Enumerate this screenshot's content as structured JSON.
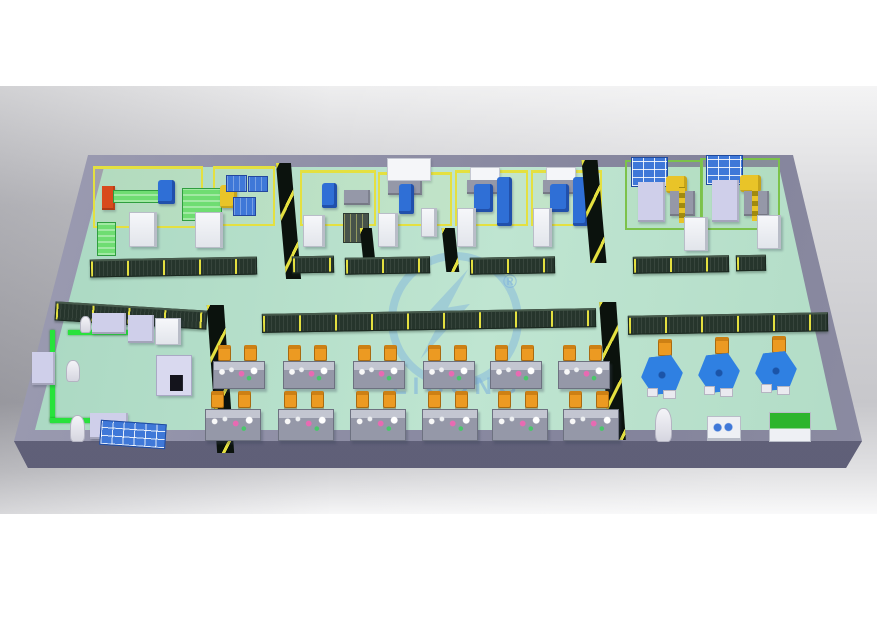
{
  "watermark": {
    "text": "LIGONG",
    "registered_mark": "®"
  },
  "colors": {
    "background_gray": "#bfbfc6",
    "platform_wall": "#8d8da3",
    "platform_front": "#5e5e77",
    "floor_green": "#b5ddc8",
    "fence_yellow": "#e4e040",
    "fence_green": "#7cc24a",
    "mesh_dark": "#26352c",
    "partition_dark": "#0b120d",
    "conveyor_green": "#28e23c",
    "robot_blue": "#2f6fd6",
    "robot_yellow": "#e9c428",
    "machine_white": "#eef0f4",
    "machine_lavender": "#cfcfea",
    "machine_red": "#d84a1c",
    "pallet_blue": "#3f78d8",
    "pallet_green": "#6fdd72",
    "bench_gray": "#9598a8",
    "chair_orange": "#ec9a22",
    "table_blue": "#2f80e2",
    "watermark_blue": "#7fb3dd"
  },
  "scene": {
    "objects": [
      {
        "n": "robot-cell-a-left-fence",
        "k": "yfence",
        "x": 93,
        "y": 166,
        "w": 110,
        "h": 62
      },
      {
        "n": "robot-cell-a-right-fence",
        "k": "yfence",
        "x": 213,
        "y": 166,
        "w": 62,
        "h": 60
      },
      {
        "n": "robot-cell-b-fence",
        "k": "yfence",
        "x": 300,
        "y": 170,
        "w": 76,
        "h": 56
      },
      {
        "n": "robot-cell-c-fence",
        "k": "yfence",
        "x": 378,
        "y": 172,
        "w": 74,
        "h": 54
      },
      {
        "n": "robot-cell-d-fence",
        "k": "yfence",
        "x": 455,
        "y": 170,
        "w": 73,
        "h": 56
      },
      {
        "n": "robot-cell-e-fence",
        "k": "yfence",
        "x": 531,
        "y": 170,
        "w": 71,
        "h": 56
      },
      {
        "n": "robot-cell-f-fence",
        "k": "gfence",
        "x": 625,
        "y": 160,
        "w": 78,
        "h": 70
      },
      {
        "n": "robot-cell-g-fence",
        "k": "gfence",
        "x": 700,
        "y": 158,
        "w": 80,
        "h": 72
      },
      {
        "n": "red-loader-machine",
        "k": "block",
        "c": "machine_red",
        "x": 102,
        "y": 186,
        "w": 13,
        "h": 24
      },
      {
        "n": "conveyor-bench-1",
        "k": "gbench",
        "x": 113,
        "y": 190,
        "w": 48,
        "h": 13
      },
      {
        "n": "robot-arm-blue-1",
        "k": "robot-b",
        "x": 158,
        "y": 180,
        "w": 17,
        "h": 24
      },
      {
        "n": "pallet-stack-green",
        "k": "gbench",
        "x": 182,
        "y": 188,
        "w": 40,
        "h": 33
      },
      {
        "n": "robot-arm-yellow-1",
        "k": "robot-y",
        "x": 220,
        "y": 185,
        "w": 17,
        "h": 23
      },
      {
        "n": "pallet-blue-1",
        "k": "bluepal",
        "x": 226,
        "y": 175,
        "w": 21,
        "h": 17
      },
      {
        "n": "pallet-blue-2",
        "k": "bluepal",
        "x": 248,
        "y": 176,
        "w": 20,
        "h": 16
      },
      {
        "n": "pallet-blue-3",
        "k": "bluepal",
        "x": 233,
        "y": 197,
        "w": 23,
        "h": 19
      },
      {
        "n": "control-cabinet-1",
        "k": "cab",
        "x": 129,
        "y": 212,
        "w": 28,
        "h": 35
      },
      {
        "n": "control-cabinet-2",
        "k": "cab",
        "x": 195,
        "y": 212,
        "w": 28,
        "h": 36
      },
      {
        "n": "conveyor-bench-2",
        "k": "gbench",
        "x": 97,
        "y": 222,
        "w": 19,
        "h": 34
      },
      {
        "n": "robot-arm-blue-2",
        "k": "robot-b",
        "x": 322,
        "y": 183,
        "w": 15,
        "h": 25
      },
      {
        "n": "work-table-1",
        "k": "block",
        "c": "bench_gray",
        "x": 344,
        "y": 190,
        "w": 26,
        "h": 15
      },
      {
        "n": "control-cabinet-3",
        "k": "cab",
        "x": 303,
        "y": 215,
        "w": 22,
        "h": 32
      },
      {
        "n": "mesh-cabinet-1",
        "k": "meshcab",
        "x": 343,
        "y": 213,
        "w": 26,
        "h": 30
      },
      {
        "n": "overhead-panel-1",
        "k": "panel",
        "x": 387,
        "y": 158,
        "w": 44,
        "h": 23
      },
      {
        "n": "machine-base-1",
        "k": "block",
        "c": "bench_gray",
        "x": 388,
        "y": 181,
        "w": 34,
        "h": 14
      },
      {
        "n": "robot-arm-blue-3",
        "k": "robot-b",
        "x": 399,
        "y": 184,
        "w": 15,
        "h": 30
      },
      {
        "n": "control-cabinet-4",
        "k": "cab",
        "x": 378,
        "y": 213,
        "w": 20,
        "h": 34
      },
      {
        "n": "control-cabinet-5",
        "k": "cab",
        "x": 421,
        "y": 208,
        "w": 16,
        "h": 29
      },
      {
        "n": "overhead-panel-2",
        "k": "panel",
        "x": 470,
        "y": 167,
        "w": 30,
        "h": 16
      },
      {
        "n": "machine-base-2",
        "k": "block",
        "c": "bench_gray",
        "x": 467,
        "y": 180,
        "w": 33,
        "h": 14
      },
      {
        "n": "robot-arm-blue-4",
        "k": "robot-b",
        "x": 474,
        "y": 184,
        "w": 19,
        "h": 28
      },
      {
        "n": "gantry-unit-1",
        "k": "robot-b",
        "x": 497,
        "y": 177,
        "w": 15,
        "h": 49
      },
      {
        "n": "control-cabinet-6",
        "k": "cab",
        "x": 457,
        "y": 208,
        "w": 19,
        "h": 39
      },
      {
        "n": "overhead-panel-3",
        "k": "panel",
        "x": 546,
        "y": 167,
        "w": 30,
        "h": 16
      },
      {
        "n": "machine-base-3",
        "k": "block",
        "c": "bench_gray",
        "x": 543,
        "y": 180,
        "w": 33,
        "h": 14
      },
      {
        "n": "robot-arm-blue-5",
        "k": "robot-b",
        "x": 550,
        "y": 184,
        "w": 19,
        "h": 28
      },
      {
        "n": "gantry-unit-2",
        "k": "robot-b",
        "x": 573,
        "y": 177,
        "w": 15,
        "h": 49
      },
      {
        "n": "control-cabinet-7",
        "k": "cab",
        "x": 533,
        "y": 208,
        "w": 19,
        "h": 39
      },
      {
        "n": "parts-rack-1",
        "k": "rack",
        "x": 631,
        "y": 157,
        "w": 37,
        "h": 30
      },
      {
        "n": "machine-lavender-1",
        "k": "block",
        "c": "machine_lavender",
        "x": 638,
        "y": 182,
        "w": 27,
        "h": 40
      },
      {
        "n": "robot-arm-yellow-2",
        "k": "robot-y",
        "x": 666,
        "y": 176,
        "w": 21,
        "h": 17
      },
      {
        "n": "machine-base-4",
        "k": "block",
        "c": "bench_gray",
        "x": 670,
        "y": 191,
        "w": 25,
        "h": 25
      },
      {
        "n": "light-curtain-1",
        "k": "stripe-y",
        "x": 679,
        "y": 187,
        "w": 6,
        "h": 36
      },
      {
        "n": "control-cabinet-8",
        "k": "cab",
        "x": 684,
        "y": 217,
        "w": 24,
        "h": 34
      },
      {
        "n": "parts-rack-2",
        "k": "rack",
        "x": 706,
        "y": 155,
        "w": 37,
        "h": 30
      },
      {
        "n": "machine-lavender-2",
        "k": "block",
        "c": "machine_lavender",
        "x": 712,
        "y": 180,
        "w": 27,
        "h": 42
      },
      {
        "n": "robot-arm-yellow-3",
        "k": "robot-y",
        "x": 740,
        "y": 175,
        "w": 21,
        "h": 17
      },
      {
        "n": "machine-base-5",
        "k": "block",
        "c": "bench_gray",
        "x": 744,
        "y": 191,
        "w": 25,
        "h": 25
      },
      {
        "n": "light-curtain-2",
        "k": "stripe-y",
        "x": 752,
        "y": 187,
        "w": 6,
        "h": 34
      },
      {
        "n": "control-cabinet-9",
        "k": "cab",
        "x": 757,
        "y": 215,
        "w": 24,
        "h": 34
      },
      {
        "n": "divider-panel-1",
        "k": "partition",
        "x": 281,
        "y": 163,
        "w": 15,
        "h": 116,
        "t": "skewX(5deg)"
      },
      {
        "n": "divider-panel-2",
        "k": "partition",
        "x": 362,
        "y": 228,
        "w": 12,
        "h": 42,
        "t": "skewX(6deg)"
      },
      {
        "n": "divider-panel-3",
        "k": "partition",
        "x": 444,
        "y": 228,
        "w": 13,
        "h": 44,
        "t": "skewX(6deg)"
      },
      {
        "n": "divider-panel-4",
        "k": "partition",
        "x": 586,
        "y": 160,
        "w": 16,
        "h": 103,
        "t": "skewX(5deg)"
      },
      {
        "n": "divider-panel-5",
        "k": "partition",
        "x": 604,
        "y": 302,
        "w": 17,
        "h": 138,
        "t": "skewX(4deg)"
      },
      {
        "n": "divider-panel-6",
        "k": "partition",
        "x": 212,
        "y": 305,
        "w": 17,
        "h": 148,
        "t": "skewX(4deg)"
      },
      {
        "n": "mesh-fence-1",
        "k": "mesh",
        "x": 90,
        "y": 258,
        "w": 167,
        "h": 18,
        "t": "rotate(-1deg)"
      },
      {
        "n": "mesh-fence-2",
        "k": "mesh",
        "x": 292,
        "y": 256,
        "w": 42,
        "h": 17,
        "t": "rotate(-1deg)"
      },
      {
        "n": "mesh-fence-3",
        "k": "mesh",
        "x": 345,
        "y": 257,
        "w": 85,
        "h": 17,
        "t": "rotate(-1deg)"
      },
      {
        "n": "mesh-fence-4",
        "k": "mesh",
        "x": 470,
        "y": 257,
        "w": 85,
        "h": 17,
        "t": "rotate(-1deg)"
      },
      {
        "n": "mesh-fence-5",
        "k": "mesh",
        "x": 633,
        "y": 256,
        "w": 96,
        "h": 17,
        "t": "rotate(-1deg)"
      },
      {
        "n": "mesh-fence-6",
        "k": "mesh",
        "x": 736,
        "y": 255,
        "w": 30,
        "h": 16,
        "t": "rotate(-1deg)"
      },
      {
        "n": "mesh-fence-7",
        "k": "mesh",
        "x": 55,
        "y": 306,
        "w": 152,
        "h": 19,
        "t": "rotate(3.5deg)"
      },
      {
        "n": "mesh-fence-8",
        "k": "mesh",
        "x": 262,
        "y": 311,
        "w": 334,
        "h": 19,
        "t": "rotate(-1deg)"
      },
      {
        "n": "mesh-fence-9",
        "k": "mesh",
        "x": 628,
        "y": 314,
        "w": 200,
        "h": 19,
        "t": "rotate(-1deg)"
      },
      {
        "n": "chair-r1c1a",
        "k": "chair",
        "x": 218,
        "y": 345,
        "w": 13,
        "h": 16
      },
      {
        "n": "chair-r1c1b",
        "k": "chair",
        "x": 244,
        "y": 345,
        "w": 13,
        "h": 16
      },
      {
        "n": "workbench-r1c1",
        "k": "bench",
        "x": 213,
        "y": 361,
        "w": 52,
        "h": 28
      },
      {
        "n": "chair-r1c2a",
        "k": "chair",
        "x": 288,
        "y": 345,
        "w": 13,
        "h": 16
      },
      {
        "n": "chair-r1c2b",
        "k": "chair",
        "x": 314,
        "y": 345,
        "w": 13,
        "h": 16
      },
      {
        "n": "workbench-r1c2",
        "k": "bench",
        "x": 283,
        "y": 361,
        "w": 52,
        "h": 28
      },
      {
        "n": "chair-r1c3a",
        "k": "chair",
        "x": 358,
        "y": 345,
        "w": 13,
        "h": 16
      },
      {
        "n": "chair-r1c3b",
        "k": "chair",
        "x": 384,
        "y": 345,
        "w": 13,
        "h": 16
      },
      {
        "n": "workbench-r1c3",
        "k": "bench",
        "x": 353,
        "y": 361,
        "w": 52,
        "h": 28
      },
      {
        "n": "chair-r1c4a",
        "k": "chair",
        "x": 428,
        "y": 345,
        "w": 13,
        "h": 16
      },
      {
        "n": "chair-r1c4b",
        "k": "chair",
        "x": 454,
        "y": 345,
        "w": 13,
        "h": 16
      },
      {
        "n": "workbench-r1c4",
        "k": "bench",
        "x": 423,
        "y": 361,
        "w": 52,
        "h": 28
      },
      {
        "n": "chair-r1c5a",
        "k": "chair",
        "x": 495,
        "y": 345,
        "w": 13,
        "h": 16
      },
      {
        "n": "chair-r1c5b",
        "k": "chair",
        "x": 521,
        "y": 345,
        "w": 13,
        "h": 16
      },
      {
        "n": "workbench-r1c5",
        "k": "bench",
        "x": 490,
        "y": 361,
        "w": 52,
        "h": 28
      },
      {
        "n": "chair-r1c6a",
        "k": "chair",
        "x": 563,
        "y": 345,
        "w": 13,
        "h": 16
      },
      {
        "n": "chair-r1c6b",
        "k": "chair",
        "x": 589,
        "y": 345,
        "w": 13,
        "h": 16
      },
      {
        "n": "workbench-r1c6",
        "k": "bench",
        "x": 558,
        "y": 361,
        "w": 52,
        "h": 28
      },
      {
        "n": "chair-r2c1a",
        "k": "chair",
        "x": 211,
        "y": 391,
        "w": 13,
        "h": 17
      },
      {
        "n": "chair-r2c1b",
        "k": "chair",
        "x": 238,
        "y": 391,
        "w": 13,
        "h": 17
      },
      {
        "n": "workbench-r2c1",
        "k": "bench",
        "x": 205,
        "y": 409,
        "w": 56,
        "h": 32
      },
      {
        "n": "chair-r2c2a",
        "k": "chair",
        "x": 284,
        "y": 391,
        "w": 13,
        "h": 17
      },
      {
        "n": "chair-r2c2b",
        "k": "chair",
        "x": 311,
        "y": 391,
        "w": 13,
        "h": 17
      },
      {
        "n": "workbench-r2c2",
        "k": "bench",
        "x": 278,
        "y": 409,
        "w": 56,
        "h": 32
      },
      {
        "n": "chair-r2c3a",
        "k": "chair",
        "x": 356,
        "y": 391,
        "w": 13,
        "h": 17
      },
      {
        "n": "chair-r2c3b",
        "k": "chair",
        "x": 383,
        "y": 391,
        "w": 13,
        "h": 17
      },
      {
        "n": "workbench-r2c3",
        "k": "bench",
        "x": 350,
        "y": 409,
        "w": 56,
        "h": 32
      },
      {
        "n": "chair-r2c4a",
        "k": "chair",
        "x": 428,
        "y": 391,
        "w": 13,
        "h": 17
      },
      {
        "n": "chair-r2c4b",
        "k": "chair",
        "x": 455,
        "y": 391,
        "w": 13,
        "h": 17
      },
      {
        "n": "workbench-r2c4",
        "k": "bench",
        "x": 422,
        "y": 409,
        "w": 56,
        "h": 32
      },
      {
        "n": "chair-r2c5a",
        "k": "chair",
        "x": 498,
        "y": 391,
        "w": 13,
        "h": 17
      },
      {
        "n": "chair-r2c5b",
        "k": "chair",
        "x": 525,
        "y": 391,
        "w": 13,
        "h": 17
      },
      {
        "n": "workbench-r2c5",
        "k": "bench",
        "x": 492,
        "y": 409,
        "w": 56,
        "h": 32
      },
      {
        "n": "chair-r2c6a",
        "k": "chair",
        "x": 569,
        "y": 391,
        "w": 13,
        "h": 17
      },
      {
        "n": "chair-r2c6b",
        "k": "chair",
        "x": 596,
        "y": 391,
        "w": 13,
        "h": 17
      },
      {
        "n": "workbench-r2c6",
        "k": "bench",
        "x": 563,
        "y": 409,
        "w": 56,
        "h": 32
      },
      {
        "n": "chair-rotary-1",
        "k": "chair",
        "x": 658,
        "y": 339,
        "w": 14,
        "h": 17
      },
      {
        "n": "rotary-table-1",
        "k": "hex",
        "x": 641,
        "y": 356,
        "w": 42,
        "h": 38
      },
      {
        "n": "rotary-table-1-leg-a",
        "k": "leg",
        "x": 647,
        "y": 388,
        "w": 11,
        "h": 9
      },
      {
        "n": "rotary-table-1-leg-b",
        "k": "leg",
        "x": 663,
        "y": 390,
        "w": 13,
        "h": 9
      },
      {
        "n": "chair-rotary-2",
        "k": "chair",
        "x": 715,
        "y": 337,
        "w": 14,
        "h": 17
      },
      {
        "n": "rotary-table-2",
        "k": "hex",
        "x": 698,
        "y": 354,
        "w": 42,
        "h": 38
      },
      {
        "n": "rotary-table-2-leg-a",
        "k": "leg",
        "x": 704,
        "y": 386,
        "w": 11,
        "h": 9
      },
      {
        "n": "rotary-table-2-leg-b",
        "k": "leg",
        "x": 720,
        "y": 388,
        "w": 13,
        "h": 9
      },
      {
        "n": "chair-rotary-3",
        "k": "chair",
        "x": 772,
        "y": 336,
        "w": 14,
        "h": 17
      },
      {
        "n": "rotary-table-3",
        "k": "hex",
        "x": 755,
        "y": 352,
        "w": 42,
        "h": 38
      },
      {
        "n": "rotary-table-3-leg-a",
        "k": "leg",
        "x": 761,
        "y": 384,
        "w": 11,
        "h": 9
      },
      {
        "n": "rotary-table-3-leg-b",
        "k": "leg",
        "x": 777,
        "y": 386,
        "w": 13,
        "h": 9
      },
      {
        "n": "robot-handler-white",
        "k": "robot-w",
        "x": 655,
        "y": 408,
        "w": 17,
        "h": 34
      },
      {
        "n": "tester-machine",
        "k": "dots2",
        "x": 707,
        "y": 416,
        "w": 34,
        "h": 25
      },
      {
        "n": "green-top-machine",
        "k": "greentop",
        "x": 769,
        "y": 412,
        "w": 42,
        "h": 30
      },
      {
        "n": "conveyor-line-top",
        "k": "conv",
        "x": 68,
        "y": 330,
        "w": 66,
        "h": 5
      },
      {
        "n": "conveyor-line-left",
        "k": "conv",
        "x": 50,
        "y": 330,
        "w": 5,
        "h": 92
      },
      {
        "n": "conveyor-line-bottom",
        "k": "conv",
        "x": 50,
        "y": 418,
        "w": 70,
        "h": 5
      },
      {
        "n": "loading-station-1",
        "k": "block",
        "c": "machine_lavender",
        "x": 92,
        "y": 313,
        "w": 34,
        "h": 21
      },
      {
        "n": "robot-figure-1",
        "k": "robot-w",
        "x": 80,
        "y": 316,
        "w": 11,
        "h": 17
      },
      {
        "n": "machine-station-2",
        "k": "block",
        "c": "machine_lavender",
        "x": 128,
        "y": 315,
        "w": 26,
        "h": 28
      },
      {
        "n": "machine-station-3",
        "k": "cab",
        "x": 155,
        "y": 318,
        "w": 26,
        "h": 27
      },
      {
        "n": "press-machine",
        "k": "pressm",
        "x": 156,
        "y": 355,
        "w": 36,
        "h": 41
      },
      {
        "n": "side-cabinet",
        "k": "block",
        "c": "machine_lavender",
        "x": 32,
        "y": 352,
        "w": 23,
        "h": 33
      },
      {
        "n": "robot-figure-2",
        "k": "robot-w",
        "x": 66,
        "y": 360,
        "w": 14,
        "h": 22
      },
      {
        "n": "robot-figure-3",
        "k": "robot-w",
        "x": 70,
        "y": 415,
        "w": 15,
        "h": 27
      },
      {
        "n": "machine-station-4",
        "k": "block",
        "c": "machine_lavender",
        "x": 90,
        "y": 413,
        "w": 38,
        "h": 26
      },
      {
        "n": "bin-rack",
        "k": "rack",
        "x": 100,
        "y": 422,
        "w": 66,
        "h": 25,
        "t": "rotate(4deg)"
      }
    ]
  }
}
